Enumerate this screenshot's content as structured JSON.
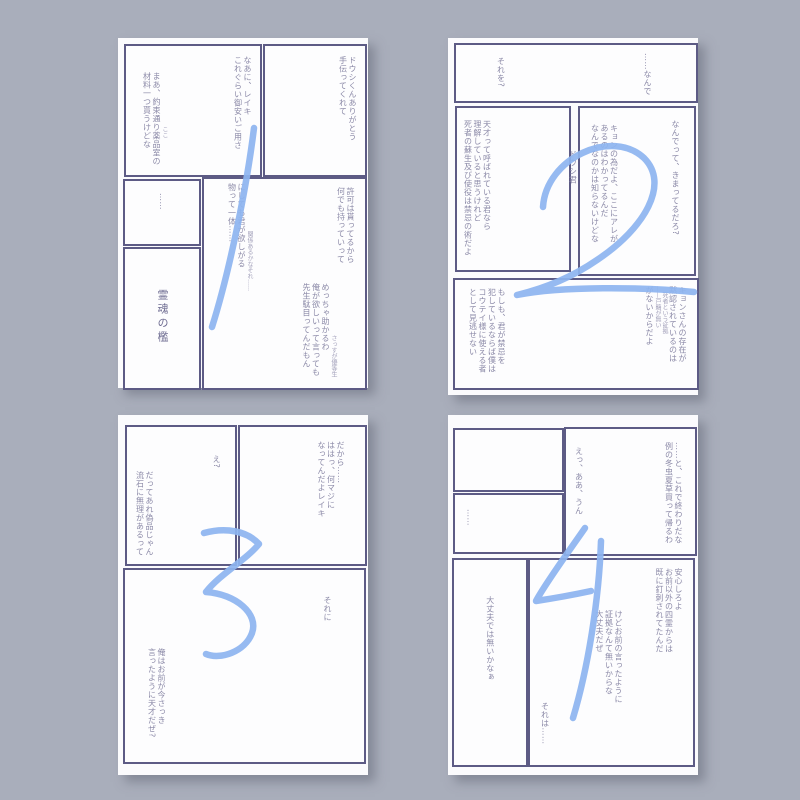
{
  "colors": {
    "background": "#a9aebb",
    "card": "#fbfbfd",
    "panel_border": "#5d5b85",
    "text": "#8c8aa8",
    "number_blue": "#8db4f0"
  },
  "pages": [
    {
      "number": "1",
      "panels": [
        {
          "blocks": [
            {
              "lines": [
                "なあに、レイキ",
                "これぐらい御安いご用さ"
              ]
            },
            {
              "note": "ここ",
              "lines": [
                "まあ、約束通り薬品室の",
                "材料一つ貰うけどな"
              ]
            }
          ]
        },
        {
          "blocks": [
            {
              "lines": [
                "ドウシくんありがとう",
                "手伝ってくれて"
              ]
            }
          ]
        },
        {
          "blocks": [
            {
              "lines": [
                "……"
              ]
            }
          ]
        },
        {
          "blocks": [
            {
              "lines": [
                "霊魂の檻"
              ]
            }
          ]
        },
        {
          "blocks": [
            {
              "lines": [
                "許可は貰ってるから",
                "何でも持っていって"
              ]
            },
            {
              "note": "関係あるかなそれ……",
              "lines": [
                "にしても君が欲しがる",
                "物って一体……"
              ]
            },
            {
              "note": "さっすが優等生",
              "lines": [
                "めっちゃ助かるわ",
                "俺が欲しいって言っても",
                "先生駄目ってんだもん"
              ]
            }
          ]
        }
      ]
    },
    {
      "number": "2",
      "gutter_note": "ドウシ君",
      "panels": [
        {
          "blocks": [
            {
              "lines": [
                "……なんで"
              ]
            },
            {
              "lines": [
                "それを?"
              ]
            }
          ]
        },
        {
          "blocks": [
            {
              "lines": [
                "天才って呼ばれている君なら",
                "理解していると思うけれど",
                "死者の蘇生及び使役は禁忌の術だよ"
              ]
            }
          ]
        },
        {
          "blocks": [
            {
              "lines": [
                "なんでって、きまってるだろ?"
              ]
            },
            {
              "lines": [
                "キョンの為だよ、ここにアレが",
                "あるのはわかってるんだ",
                "なんでなのかは知らないけどな"
              ]
            }
          ]
        },
        {
          "blocks": [
            {
              "lines": [
                "キョンさんの存在が",
                "黙認されているのは",
                "死者という証拠",
                "——戸籍が無い",
                "がないからだよ"
              ]
            },
            {
              "lines": [
                "もしも、君が禁忌を",
                "犯しているならば僕は",
                "コウテイ様に使える者",
                "として見逃せない"
              ]
            }
          ]
        }
      ]
    },
    {
      "number": "3",
      "panels": [
        {
          "blocks": [
            {
              "lines": [
                "え?"
              ]
            },
            {
              "lines": [
                "だってあれ偽品じゃん",
                "流石に無理があるって"
              ]
            }
          ]
        },
        {
          "blocks": [
            {
              "lines": [
                "だから……",
                "ははっ、何マジに",
                "なってんだよレイキ"
              ]
            }
          ]
        },
        {
          "blocks": [
            {
              "lines": [
                "それに"
              ]
            },
            {
              "lines": [
                "俺はお前が今さっき",
                "言ったように天才だぜ?"
              ]
            }
          ]
        }
      ]
    },
    {
      "number": "4",
      "panels": [
        {
          "blocks": []
        },
        {
          "blocks": [
            {
              "lines": [
                "……"
              ]
            }
          ]
        },
        {
          "blocks": [
            {
              "lines": [
                "……と、これで終わりだな",
                "例の冬虫夏草買って帰るわ"
              ]
            },
            {
              "lines": [
                "えっ、ああ、うん"
              ]
            }
          ]
        },
        {
          "blocks": [
            {
              "lines": [
                "大丈夫では無いかなぁ"
              ]
            }
          ]
        },
        {
          "blocks": [
            {
              "lines": [
                "安心しろよ",
                "お前以外の四霊からは",
                "既に釘刺されてたんだ"
              ]
            },
            {
              "lines": [
                "けどお前の言ったように",
                "証拠なんて無いからな",
                "大丈夫だぜ"
              ]
            },
            {
              "lines": [
                "それは……"
              ]
            }
          ]
        }
      ]
    }
  ]
}
